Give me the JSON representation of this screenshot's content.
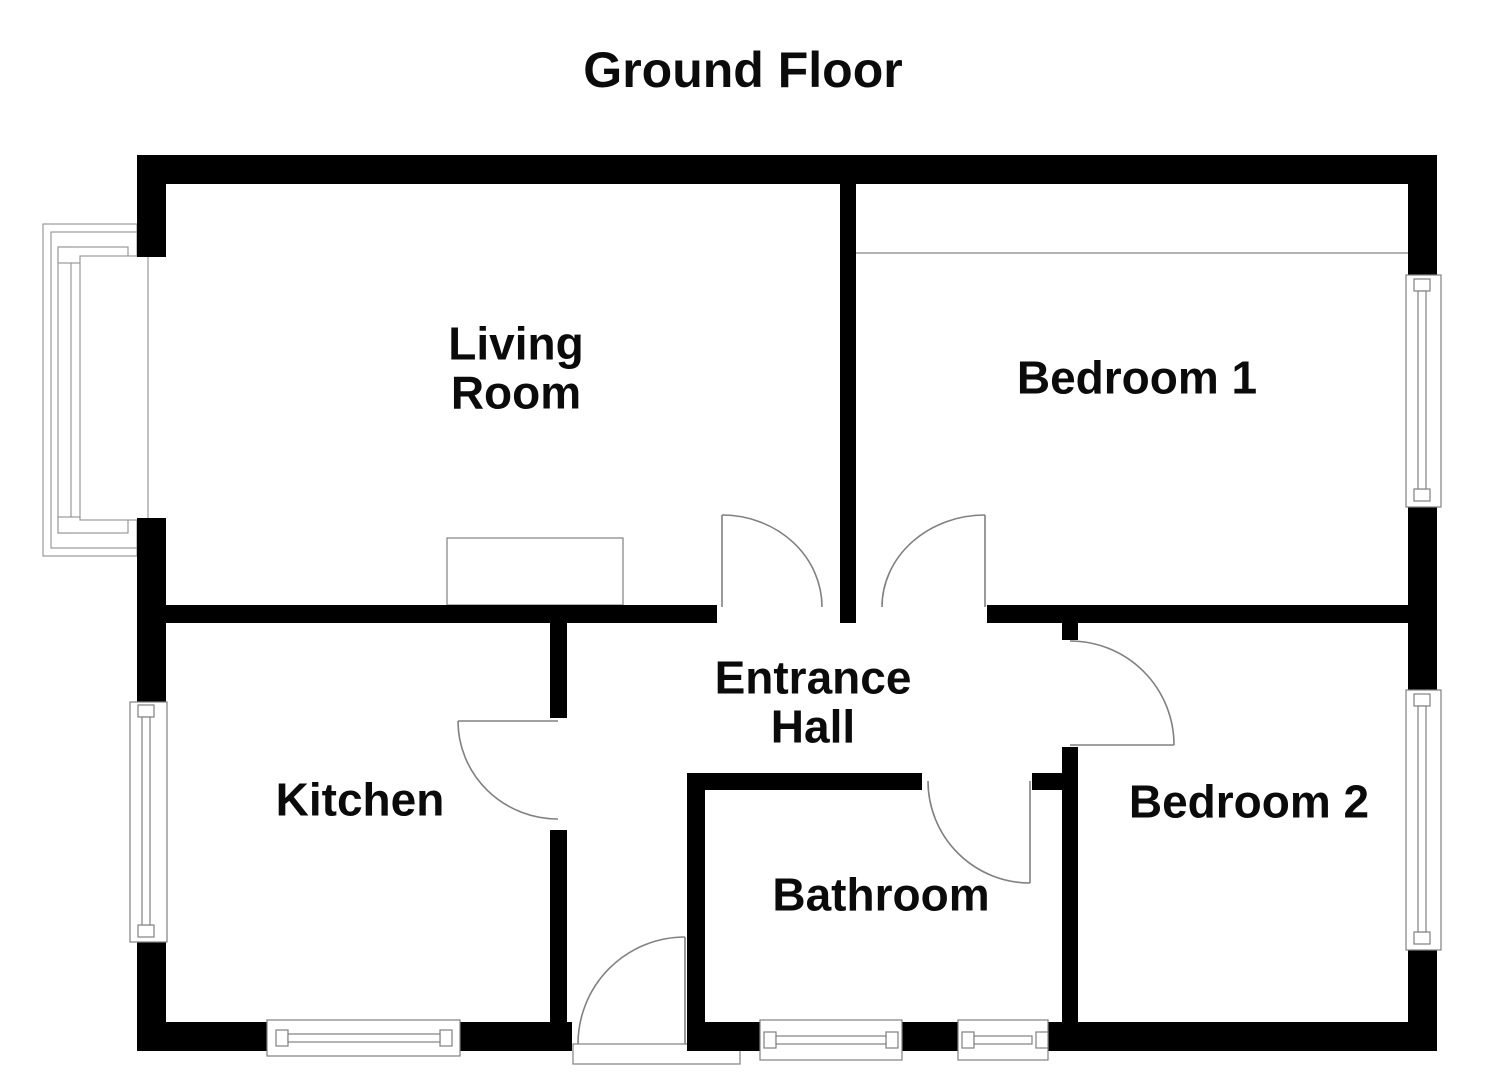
{
  "canvas": {
    "width": 1485,
    "height": 1080,
    "background": "#ffffff"
  },
  "colors": {
    "wall": "#000000",
    "detail_line": "#808080",
    "text": "#0b0b0b"
  },
  "title": "Ground Floor",
  "rooms": {
    "living_room": {
      "line1": "Living",
      "line2": "Room"
    },
    "bedroom_1": {
      "name": "Bedroom 1"
    },
    "entrance_hall": {
      "line1": "Entrance",
      "line2": "Hall"
    },
    "kitchen": {
      "name": "Kitchen"
    },
    "bathroom": {
      "name": "Bathroom"
    },
    "bedroom_2": {
      "name": "Bedroom 2"
    }
  },
  "features": {
    "doors": [
      "front-door",
      "living-room-door",
      "bedroom-1-door",
      "bedroom-2-door",
      "kitchen-door",
      "bathroom-door"
    ],
    "windows": [
      "living-room-bay-window",
      "kitchen-side-window",
      "kitchen-rear-window",
      "bathroom-window-left",
      "bathroom-window-right",
      "bedroom-1-window",
      "bedroom-2-window"
    ],
    "other": [
      "living-room-fireplace",
      "bedroom-1-wardrobe-line",
      "front-door-step"
    ]
  }
}
